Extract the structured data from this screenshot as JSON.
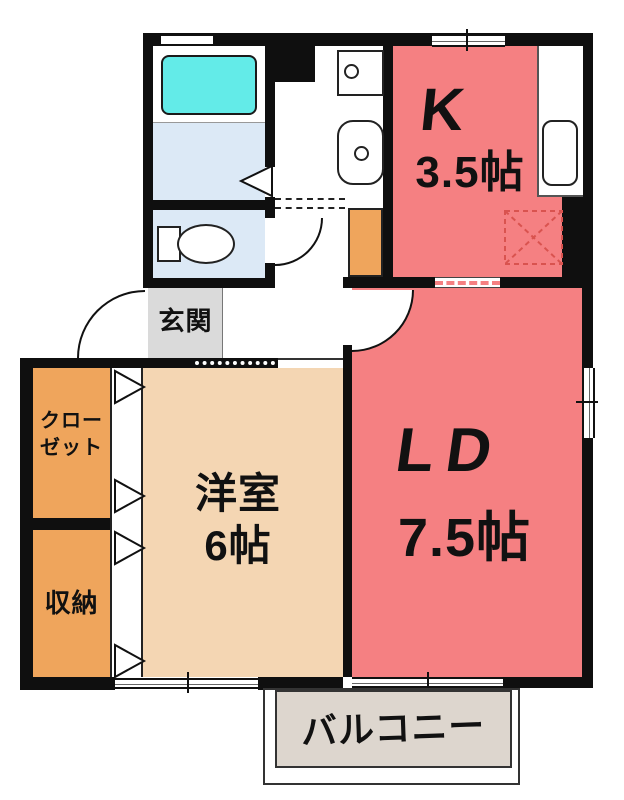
{
  "title": "apartment floor plan",
  "rooms": {
    "kitchen": {
      "label": "K",
      "size": "3.5帖"
    },
    "living_dining": {
      "label": "LD",
      "size": "7.5帖"
    },
    "western_room": {
      "label": "洋室",
      "size": "6帖"
    },
    "entrance": {
      "label": "玄関"
    },
    "closet": {
      "line1": "クロー",
      "line2": "ゼット"
    },
    "storage": {
      "label": "収納"
    },
    "balcony": {
      "label": "バルコニー"
    }
  },
  "fixtures": {
    "bathtub": "bathtub-icon",
    "toilet": "toilet-icon",
    "washbasin": "washbasin-icon",
    "washing_machine_pan": "washing-machine-pan-icon",
    "kitchen_sink": "kitchen-sink-icon",
    "refrigerator_space": "refrigerator-space-icon"
  },
  "colors": {
    "wall": "#0f0f0f",
    "room_salmon": "#f58082",
    "room_beige": "#f4d6b3",
    "room_orange": "#efa55c",
    "entrance_gray": "#dadada",
    "balcony_gray": "#ddd6ce",
    "wet_area_blue": "#dce9f6",
    "bathtub_cyan": "#63ebe8",
    "refrigerator_dash": "#d9534f"
  }
}
